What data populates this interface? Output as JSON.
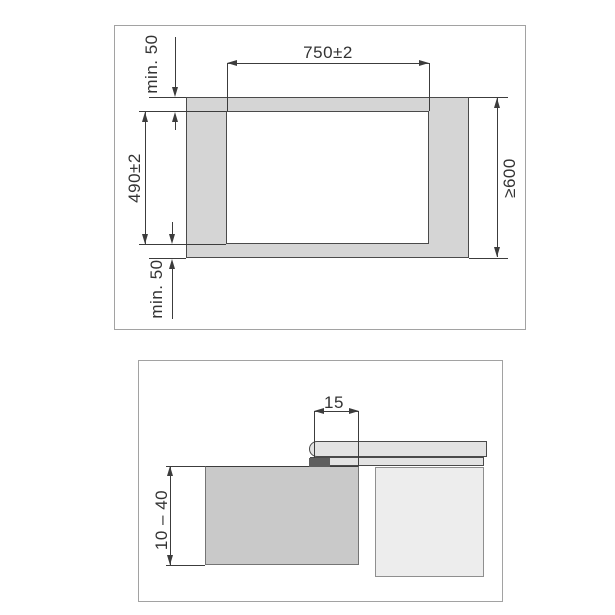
{
  "figure": {
    "background": "#ffffff",
    "line_color": "#3c3c3c",
    "panel_border_color": "#a2a2a2"
  },
  "top_view": {
    "name": "worktop-cutout-top-view",
    "worktop_fill": "#d5d5d5",
    "cutout_fill": "#ffffff",
    "dimensions": {
      "rear_clearance": "min. 50",
      "cutout_width": "750±2",
      "cutout_depth": "490±2",
      "front_clearance": "min. 50",
      "worktop_depth": "≥600"
    }
  },
  "section_view": {
    "name": "installation-cross-section",
    "worktop_fill": "#c9c9c9",
    "cooktop_glass_fill": "#e3e3e3",
    "cabinet_fill": "#ededed",
    "seal_fill": "#5e5e5e",
    "dimensions": {
      "overlap": "15",
      "worktop_thickness": "10 – 40"
    }
  }
}
